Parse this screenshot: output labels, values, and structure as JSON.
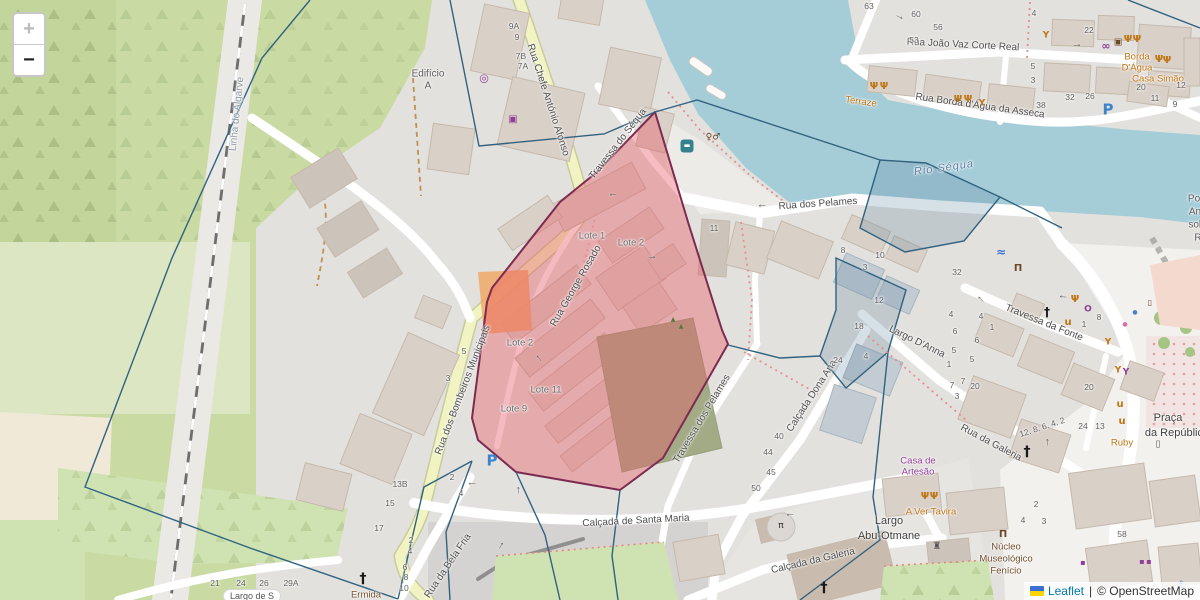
{
  "palette": {
    "base": "#e3e1dd",
    "green": "#c9dba3",
    "green2": "#cfe3b2",
    "orchard": "#c2d69c",
    "pale_green": "#dde6c3",
    "peach": "#f0e9d8",
    "water": "#a5cdd8",
    "river_label": "#5b7fa6",
    "road_yellow": "#f1f4c2",
    "road_casing": "#c8cb9c",
    "road_white": "#ffffff",
    "building": "#d9d0c8",
    "building_stroke": "#c6b9ab",
    "red_fill": "rgba(233,88,99,0.40)",
    "red_stroke": "#7c2b50",
    "blue_line": "#31627f",
    "blue_fill": "rgba(90,130,160,0.25)",
    "red_dash": "#e09090",
    "orange_patch": "#f0a868",
    "olive": "#a2aa86",
    "poi_orange": "#bf7615",
    "shop_purple": "#8f3f97",
    "brown": "#735030",
    "number_grey": "#5e5e5e",
    "street_label": "#4c4c4c",
    "parking_blue": "#3f83c9",
    "link_blue": "#0078a8"
  },
  "controls": {
    "zoom_in_label": "+",
    "zoom_out_label": "−"
  },
  "attribution": {
    "leaflet_label": "Leaflet",
    "divider": "|",
    "osm_label": "© OpenStreetMap"
  },
  "map": {
    "street_labels": [
      {
        "name": "street-rua-chefe-antonio-afonso",
        "text": "Rua Chefe António Afonso",
        "x": 548,
        "y": 100,
        "rot": 72
      },
      {
        "name": "street-travessa-do-sequa",
        "text": "Travessa do Séqua",
        "x": 618,
        "y": 144,
        "rot": -52
      },
      {
        "name": "street-rua-dos-pelames",
        "text": "Rua dos Pelames",
        "x": 818,
        "y": 204,
        "rot": -4
      },
      {
        "name": "street-rua-george-rosado",
        "text": "Rua George Rosado",
        "x": 576,
        "y": 286,
        "rot": -60
      },
      {
        "name": "street-rua-dos-bombeiros-municipais",
        "text": "Rua dos Bombeiros Municipais",
        "x": 463,
        "y": 390,
        "rot": -69
      },
      {
        "name": "street-calcada-de-santa-maria",
        "text": "Calçada de Santa Maria",
        "x": 636,
        "y": 521,
        "rot": -3
      },
      {
        "name": "street-rua-da-bela-fria",
        "text": "Rua da Bela Fria",
        "x": 448,
        "y": 566,
        "rot": -56
      },
      {
        "name": "street-travessa-dos-pelames",
        "text": "Travessa dos Pelames",
        "x": 702,
        "y": 419,
        "rot": -59
      },
      {
        "name": "street-calcada-dona-ana",
        "text": "Calçada Dona Ana",
        "x": 812,
        "y": 396,
        "rot": -57
      },
      {
        "name": "street-largo-danna",
        "text": "Largo D'Anna",
        "x": 917,
        "y": 342,
        "rot": 26
      },
      {
        "name": "street-travessa-da-fonte",
        "text": "Travessa da Fonte",
        "x": 1044,
        "y": 323,
        "rot": 22
      },
      {
        "name": "street-rua-da-galeria",
        "text": "Rua da Galeria",
        "x": 991,
        "y": 443,
        "rot": 28
      },
      {
        "name": "street-calcada-da-galeria",
        "text": "Calçada da Galeria",
        "x": 813,
        "y": 561,
        "rot": -13
      },
      {
        "name": "street-rua-joao-vaz-corte-real",
        "text": "Rua João Vaz Corte Real",
        "x": 963,
        "y": 45,
        "rot": 3
      },
      {
        "name": "street-rua-borda-dagua-da-asseca",
        "text": "Rua Borda d'Água da Asseca",
        "x": 980,
        "y": 106,
        "rot": 8
      },
      {
        "name": "railway-linha-do-algarve",
        "text": "Linha do Algarve",
        "x": 237,
        "y": 114,
        "rot": -84,
        "cls": "rail"
      },
      {
        "name": "water-rio-sequa",
        "text": "Rio Séqua",
        "x": 944,
        "y": 168,
        "rot": -8,
        "cls": "water"
      },
      {
        "name": "place-largo-abu-otmane",
        "text": "Largo",
        "x": 889,
        "y": 521,
        "cls": "place"
      },
      {
        "name": "place-largo-abu-otmane",
        "text": "Abu-Otmane",
        "x": 889,
        "y": 536,
        "cls": "place"
      },
      {
        "name": "place-praca-da-republica",
        "text": "Praça",
        "x": 1168,
        "y": 418,
        "cls": "place"
      },
      {
        "name": "place-praca-da-republica",
        "text": "da República",
        "x": 1177,
        "y": 433,
        "cls": "place"
      },
      {
        "name": "place-edificio-a",
        "text": "Edifício",
        "x": 428,
        "y": 74,
        "cls": "place2"
      },
      {
        "name": "place-edificio-a",
        "text": "A",
        "x": 428,
        "y": 86,
        "cls": "place2"
      },
      {
        "name": "lote-label",
        "text": "Lote 1",
        "x": 592,
        "y": 236,
        "cls": "lote"
      },
      {
        "name": "lote-label",
        "text": "Lote 2",
        "x": 631,
        "y": 243,
        "cls": "lote"
      },
      {
        "name": "lote-label",
        "text": "Lote 2",
        "x": 520,
        "y": 343,
        "cls": "lote"
      },
      {
        "name": "lote-label",
        "text": "Lote 11",
        "x": 546,
        "y": 390,
        "cls": "lote"
      },
      {
        "name": "lote-label",
        "text": "Lote 9",
        "x": 514,
        "y": 409,
        "cls": "lote"
      },
      {
        "name": "poi-terraze",
        "text": "Terraze",
        "x": 861,
        "y": 102,
        "rot": 8,
        "cls": "poi"
      },
      {
        "name": "poi-borda-dagua",
        "text": "Borda",
        "x": 1137,
        "y": 57,
        "cls": "poi"
      },
      {
        "name": "poi-borda-dagua",
        "text": "D'Água",
        "x": 1137,
        "y": 68,
        "cls": "poi"
      },
      {
        "name": "poi-casa-simao",
        "text": "Casa Simão",
        "x": 1158,
        "y": 79,
        "cls": "poi"
      },
      {
        "name": "poi-a-ver-tavira",
        "text": "A Ver Tavira",
        "x": 931,
        "y": 512,
        "cls": "poi"
      },
      {
        "name": "poi-ruby",
        "text": "Ruby",
        "x": 1122,
        "y": 443,
        "cls": "poi"
      },
      {
        "name": "shop-casa-de-artesao",
        "text": "Casa de",
        "x": 918,
        "y": 461,
        "cls": "shop"
      },
      {
        "name": "shop-casa-de-artesao",
        "text": "Artesão",
        "x": 918,
        "y": 472,
        "cls": "shop"
      },
      {
        "name": "poi-nucleo-museologico",
        "text": "Núcleo",
        "x": 1006,
        "y": 547,
        "cls": "brown"
      },
      {
        "name": "poi-nucleo-museologico",
        "text": "Museológico",
        "x": 1006,
        "y": 559,
        "cls": "brown"
      },
      {
        "name": "poi-nucleo-museologico",
        "text": "Fenício",
        "x": 1006,
        "y": 571,
        "cls": "brown"
      },
      {
        "name": "poi-ermida",
        "text": "Ermida",
        "x": 366,
        "y": 595,
        "cls": "brown"
      },
      {
        "name": "poi-ponte-antiga",
        "text": "Ponte",
        "x": 1201,
        "y": 199,
        "cls": "place2"
      },
      {
        "name": "poi-ponte-antiga",
        "text": "Antiga",
        "x": 1203,
        "y": 212,
        "cls": "place2"
      },
      {
        "name": "poi-ponte-antiga",
        "text": "sobre o",
        "x": 1205,
        "y": 225,
        "cls": "place2"
      },
      {
        "name": "poi-ponte-antiga",
        "text": "Rio Gilão",
        "x": 1215,
        "y": 238,
        "cls": "place2"
      },
      {
        "name": "place-largo-de-s",
        "text": "Largo de S",
        "x": 252,
        "y": 596,
        "cls": "pill"
      }
    ],
    "house_numbers": [
      [
        "9A",
        514,
        26
      ],
      [
        "9",
        517,
        37
      ],
      [
        "7B",
        521,
        56
      ],
      [
        "7A",
        523,
        66
      ],
      [
        "63",
        869,
        6
      ],
      [
        "60",
        916,
        14
      ],
      [
        "56",
        938,
        27
      ],
      [
        "53",
        914,
        40
      ],
      [
        "4",
        1034,
        13
      ],
      [
        "22",
        1089,
        30
      ],
      [
        "5",
        1033,
        66
      ],
      [
        "3",
        1033,
        80
      ],
      [
        "38",
        1041,
        105
      ],
      [
        "32",
        1070,
        97
      ],
      [
        "26",
        1090,
        96
      ],
      [
        "20",
        1141,
        87
      ],
      [
        "12",
        1181,
        85
      ],
      [
        "11",
        1155,
        98
      ],
      [
        "9",
        1175,
        104
      ],
      [
        "11",
        714,
        228
      ],
      [
        "8",
        843,
        250
      ],
      [
        "10",
        880,
        255
      ],
      [
        "3",
        865,
        267
      ],
      [
        "12",
        879,
        300
      ],
      [
        "18",
        859,
        326
      ],
      [
        "24",
        838,
        360
      ],
      [
        "4",
        866,
        356
      ],
      [
        "40",
        779,
        436
      ],
      [
        "44",
        768,
        452
      ],
      [
        "45",
        771,
        472
      ],
      [
        "50",
        756,
        488
      ],
      [
        "32",
        957,
        272
      ],
      [
        "4",
        981,
        316
      ],
      [
        "1",
        992,
        327
      ],
      [
        "6",
        977,
        340
      ],
      [
        "5",
        972,
        359
      ],
      [
        "7",
        963,
        381
      ],
      [
        "4",
        951,
        314
      ],
      [
        "6",
        955,
        331
      ],
      [
        "5",
        954,
        350
      ],
      [
        "1",
        949,
        364
      ],
      [
        "7",
        952,
        385
      ],
      [
        "3",
        957,
        396
      ],
      [
        "20",
        975,
        386
      ],
      [
        "20",
        1089,
        387
      ],
      [
        "8",
        1099,
        317
      ],
      [
        "1",
        1084,
        324
      ],
      [
        "24",
        1083,
        426
      ],
      [
        "13",
        1100,
        426
      ],
      [
        "12. 8. 6. 4. 2",
        1042,
        427,
        -18
      ],
      [
        "13B",
        400,
        484
      ],
      [
        "15",
        390,
        503
      ],
      [
        "2",
        452,
        477
      ],
      [
        "4",
        461,
        493
      ],
      [
        "17",
        379,
        528
      ],
      [
        "2",
        411,
        540
      ],
      [
        "4",
        410,
        551
      ],
      [
        "6",
        405,
        567
      ],
      [
        "8",
        406,
        577
      ],
      [
        "10",
        404,
        588
      ],
      [
        "21",
        215,
        583
      ],
      [
        "24",
        241,
        583
      ],
      [
        "26",
        264,
        583
      ],
      [
        "29A",
        291,
        583
      ],
      [
        "58",
        1122,
        534
      ],
      [
        "2",
        1036,
        504
      ],
      [
        "4",
        1023,
        520
      ],
      [
        "3",
        1044,
        521
      ],
      [
        "5",
        464,
        351
      ],
      [
        "3",
        448,
        378
      ]
    ],
    "pois": [
      {
        "n": "bus-stop-icon",
        "g": "▬",
        "x": 687,
        "y": 146,
        "c": "#ffffff",
        "s": 7,
        "bg": "#36818e",
        "w": 13
      },
      {
        "n": "toilets-icon",
        "g": "♀♂",
        "x": 713,
        "y": 138,
        "c": "#6b4a2a",
        "s": 9,
        "b": 1
      },
      {
        "n": "amenity-circle-icon",
        "g": "◎",
        "x": 484,
        "y": 78,
        "c": "#8f3f97",
        "s": 11,
        "b": 1
      },
      {
        "n": "shop-icon",
        "g": "▣",
        "x": 513,
        "y": 120,
        "c": "#8f3f97",
        "s": 10
      },
      {
        "n": "bicycle-rental-icon",
        "g": "∞",
        "x": 1106,
        "y": 46,
        "c": "#8f3f97",
        "s": 11,
        "b": 1
      },
      {
        "n": "artwork-icon",
        "g": "▣",
        "x": 1118,
        "y": 43,
        "c": "#6b4a2a",
        "s": 9
      },
      {
        "n": "restaurant-icon",
        "g": "Ψ",
        "x": 1128,
        "y": 40,
        "c": "#bf7615",
        "s": 10,
        "b": 1
      },
      {
        "n": "restaurant-icon",
        "g": "Ψ",
        "x": 1137,
        "y": 40,
        "c": "#bf7615",
        "s": 10,
        "b": 1
      },
      {
        "n": "restaurant-icon",
        "g": "Ψ",
        "x": 874,
        "y": 87,
        "c": "#bf7615",
        "s": 10,
        "b": 1
      },
      {
        "n": "restaurant-icon",
        "g": "Ψ",
        "x": 884,
        "y": 87,
        "c": "#bf7615",
        "s": 10,
        "b": 1
      },
      {
        "n": "restaurant-icon",
        "g": "Ψ",
        "x": 958,
        "y": 100,
        "c": "#bf7615",
        "s": 10,
        "b": 1
      },
      {
        "n": "restaurant-icon",
        "g": "Ψ",
        "x": 968,
        "y": 100,
        "c": "#bf7615",
        "s": 10,
        "b": 1
      },
      {
        "n": "restaurant-icon",
        "g": "Ψ",
        "x": 925,
        "y": 497,
        "c": "#bf7615",
        "s": 10,
        "b": 1
      },
      {
        "n": "restaurant-icon",
        "g": "Ψ",
        "x": 934,
        "y": 497,
        "c": "#bf7615",
        "s": 10,
        "b": 1
      },
      {
        "n": "restaurant-icon",
        "g": "Ψ",
        "x": 1159,
        "y": 60,
        "c": "#bf7615",
        "s": 10,
        "b": 1
      },
      {
        "n": "restaurant-icon",
        "g": "Ψ",
        "x": 1167,
        "y": 61,
        "c": "#bf7615",
        "s": 10,
        "b": 1
      },
      {
        "n": "restaurant-icon",
        "g": "Ψ",
        "x": 1075,
        "y": 300,
        "c": "#bf7615",
        "s": 10,
        "b": 1
      },
      {
        "n": "bar-icon",
        "g": "Y",
        "x": 982,
        "y": 104,
        "c": "#bf7615",
        "s": 9,
        "b": 1
      },
      {
        "n": "bar-icon",
        "g": "Y",
        "x": 1046,
        "y": 36,
        "c": "#bf7615",
        "s": 9,
        "b": 1
      },
      {
        "n": "bar-icon",
        "g": "Y",
        "x": 1108,
        "y": 343,
        "c": "#bf7615",
        "s": 9,
        "b": 1
      },
      {
        "n": "bar-icon",
        "g": "Y",
        "x": 1118,
        "y": 371,
        "c": "#bf7615",
        "s": 9,
        "b": 1
      },
      {
        "n": "bar-icon",
        "g": "Y",
        "x": 1126,
        "y": 373,
        "c": "#8f3f97",
        "s": 9,
        "b": 1
      },
      {
        "n": "cafe-icon",
        "g": "u",
        "x": 1068,
        "y": 323,
        "c": "#bf7615",
        "s": 10,
        "b": 1
      },
      {
        "n": "cafe-icon",
        "g": "u",
        "x": 1120,
        "y": 405,
        "c": "#bf7615",
        "s": 10,
        "b": 1
      },
      {
        "n": "cafe-icon",
        "g": "u",
        "x": 1122,
        "y": 422,
        "c": "#bf7615",
        "s": 10,
        "b": 1
      },
      {
        "n": "fountain-icon",
        "g": "≈",
        "x": 1001,
        "y": 252,
        "c": "#3a6fd8",
        "s": 12,
        "b": 1
      },
      {
        "n": "museum-icon",
        "g": "Π",
        "x": 1018,
        "y": 269,
        "c": "#6b4a2a",
        "s": 10,
        "b": 1
      },
      {
        "n": "museum-icon",
        "g": "Π",
        "x": 1003,
        "y": 535,
        "c": "#6b4a2a",
        "s": 10,
        "b": 1
      },
      {
        "n": "church-cross-icon",
        "g": "†",
        "x": 1047,
        "y": 312,
        "c": "#1a1a1a",
        "s": 12,
        "b": 1
      },
      {
        "n": "church-cross-icon",
        "g": "†",
        "x": 1027,
        "y": 452,
        "c": "#1a1a1a",
        "s": 14,
        "b": 1
      },
      {
        "n": "church-cross-icon",
        "g": "†",
        "x": 363,
        "y": 579,
        "c": "#1a1a1a",
        "s": 14,
        "b": 1
      },
      {
        "n": "church-cross-icon",
        "g": "†",
        "x": 824,
        "y": 588,
        "c": "#1a1a1a",
        "s": 14,
        "b": 1
      },
      {
        "n": "castle-icon",
        "g": "♜",
        "x": 937,
        "y": 547,
        "c": "#555555",
        "s": 10
      },
      {
        "n": "parking-icon",
        "g": "P",
        "x": 492,
        "y": 461,
        "c": "#3f83c9",
        "s": 15,
        "b": 1
      },
      {
        "n": "parking-icon",
        "g": "P",
        "x": 1108,
        "y": 110,
        "c": "#3f83c9",
        "s": 15,
        "b": 1
      },
      {
        "n": "jewelry-icon",
        "g": "O",
        "x": 1088,
        "y": 310,
        "c": "#8f3f97",
        "s": 9,
        "b": 1
      },
      {
        "n": "monument-icon",
        "g": "▯",
        "x": 1158,
        "y": 445,
        "c": "#555555",
        "s": 9
      },
      {
        "n": "memorial-icon",
        "g": "▯",
        "x": 1150,
        "y": 303,
        "c": "#6b4a2a",
        "s": 8
      },
      {
        "n": "marker-dot-icon",
        "g": "●",
        "x": 1135,
        "y": 313,
        "c": "#4a7fc1",
        "s": 6
      },
      {
        "n": "marker-dot-icon",
        "g": "●",
        "x": 1125,
        "y": 325,
        "c": "#d86da8",
        "s": 6
      },
      {
        "n": "shop-icon",
        "g": "▪",
        "x": 1083,
        "y": 563,
        "c": "#8f3f97",
        "s": 8
      },
      {
        "n": "shop-icon",
        "g": "▪",
        "x": 1142,
        "y": 562,
        "c": "#8f3f97",
        "s": 8
      },
      {
        "n": "shop-icon",
        "g": "▪",
        "x": 1149,
        "y": 562,
        "c": "#8f3f97",
        "s": 8
      },
      {
        "n": "anchor-icon",
        "g": "⚓",
        "x": 1181,
        "y": 586,
        "c": "#3a6fd8",
        "s": 10
      },
      {
        "n": "tree-icon",
        "g": "▲",
        "x": 673,
        "y": 320,
        "c": "#4f7a3a",
        "s": 6
      },
      {
        "n": "tree-icon",
        "g": "▲",
        "x": 681,
        "y": 327,
        "c": "#4f7a3a",
        "s": 6
      },
      {
        "n": "picnic-icon",
        "g": "π",
        "x": 781,
        "y": 526,
        "c": "#333333",
        "s": 9,
        "bg": "#dbd7d3",
        "w": 16,
        "r": 1
      }
    ],
    "arrows": [
      [
        900,
        16,
        25
      ],
      [
        1077,
        44,
        0
      ],
      [
        762,
        207,
        180
      ],
      [
        652,
        256,
        0
      ],
      [
        613,
        196,
        180
      ],
      [
        538,
        359,
        -130
      ],
      [
        472,
        485,
        180
      ],
      [
        517,
        490,
        -90
      ],
      [
        790,
        516,
        180
      ],
      [
        500,
        545,
        -60
      ],
      [
        980,
        300,
        -135
      ],
      [
        1063,
        298,
        185
      ],
      [
        1046,
        442,
        -90
      ]
    ]
  }
}
